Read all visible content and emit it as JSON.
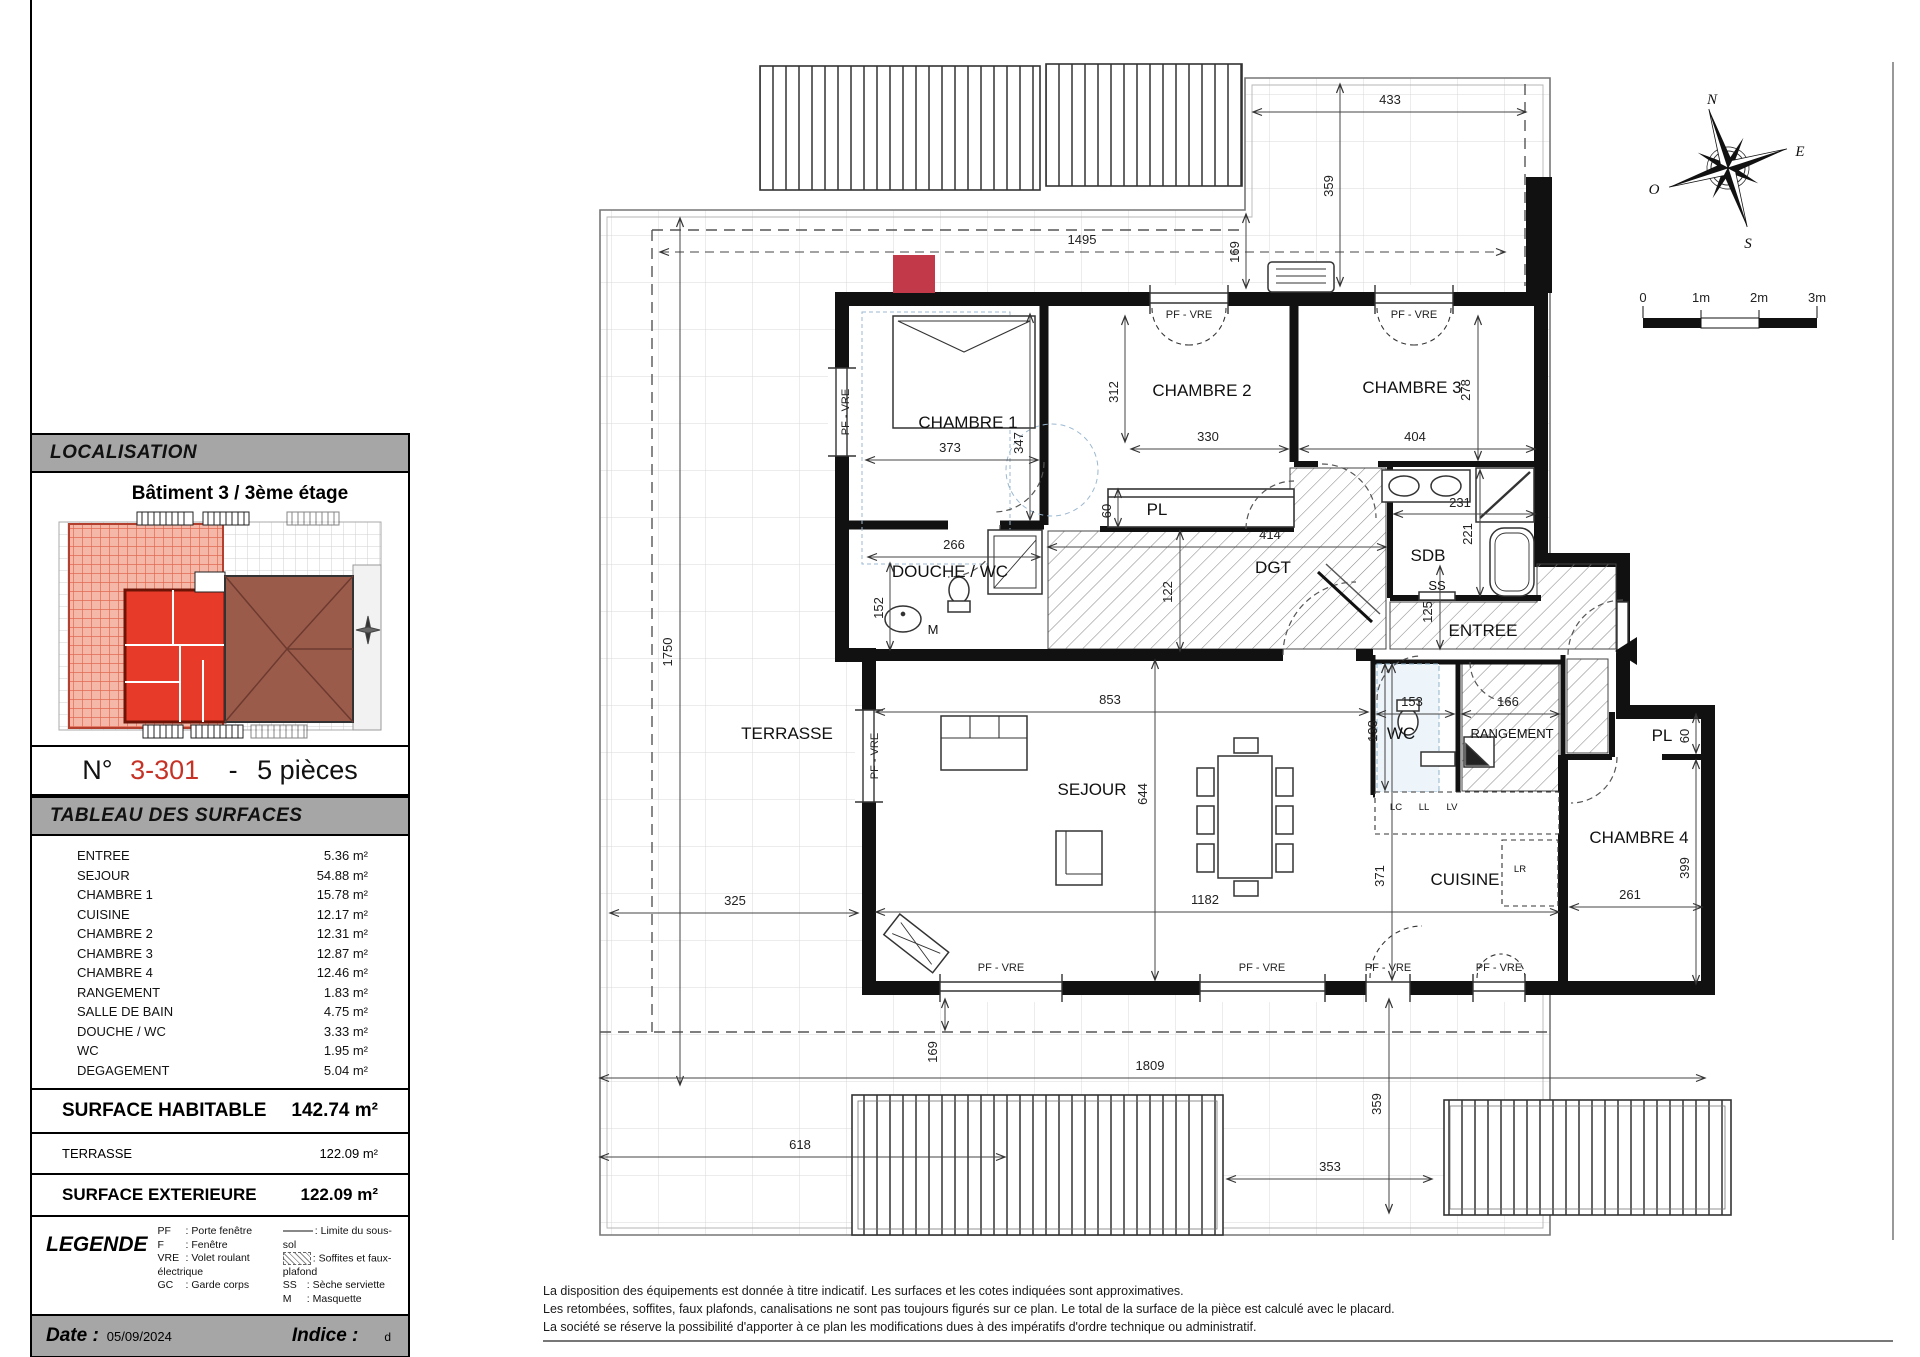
{
  "localisation": {
    "title": "LOCALISATION",
    "building": "Bâtiment 3 / 3ème étage"
  },
  "unit": {
    "prefix": "N°",
    "number": "3-301",
    "sep": "-",
    "type": "5 pièces"
  },
  "surfaces": {
    "title": "TABLEAU DES SURFACES",
    "rows": [
      {
        "name": "ENTREE",
        "area": "5.36 m²"
      },
      {
        "name": "SEJOUR",
        "area": "54.88 m²"
      },
      {
        "name": "CHAMBRE 1",
        "area": "15.78 m²"
      },
      {
        "name": "CUISINE",
        "area": "12.17 m²"
      },
      {
        "name": "CHAMBRE 2",
        "area": "12.31 m²"
      },
      {
        "name": "CHAMBRE 3",
        "area": "12.87 m²"
      },
      {
        "name": "CHAMBRE 4",
        "area": "12.46 m²"
      },
      {
        "name": "RANGEMENT",
        "area": "1.83 m²"
      },
      {
        "name": "SALLE DE BAIN",
        "area": "4.75 m²"
      },
      {
        "name": "DOUCHE / WC",
        "area": "3.33 m²"
      },
      {
        "name": "WC",
        "area": "1.95 m²"
      },
      {
        "name": "DEGAGEMENT",
        "area": "5.04 m²"
      }
    ],
    "habitable_label": "SURFACE HABITABLE",
    "habitable_value": "142.74 m²",
    "terrasse_label": "TERRASSE",
    "terrasse_value": "122.09 m²",
    "exterieure_label": "SURFACE EXTERIEURE",
    "exterieure_value": "122.09 m²"
  },
  "legende": {
    "title": "LEGENDE",
    "col1": [
      {
        "abbr": "PF",
        "label": ": Porte fenêtre"
      },
      {
        "abbr": "F",
        "label": ": Fenêtre"
      },
      {
        "abbr": "VRE",
        "label": ": Volet roulant électrique"
      },
      {
        "abbr": "GC",
        "label": ": Garde corps"
      }
    ],
    "col2": [
      {
        "abbr": "",
        "label": ": Limite du sous-sol"
      },
      {
        "abbr": "",
        "label": ": Soffites et faux-plafond"
      },
      {
        "abbr": "SS",
        "label": ": Sèche serviette"
      },
      {
        "abbr": "M",
        "label": ": Masquette"
      }
    ]
  },
  "footer": {
    "date_label": "Date :",
    "date": "05/09/2024",
    "indice_label": "Indice :",
    "indice": "d"
  },
  "disclaimer": {
    "line1": "La disposition des équipements est donnée à titre indicatif. Les surfaces et les cotes indiquées sont approximatives.",
    "line2": "Les retombées, soffites, faux plafonds, canalisations ne sont pas toujours figurés sur ce plan. Le total de la surface de la pièce est calculé avec le placard.",
    "line3": "La société se réserve la possibilité d'apporter à ce plan les modifications dues à des impératifs d'ordre technique ou administratif."
  },
  "plan": {
    "rooms": {
      "terrasse": "TERRASSE",
      "sejour": "SEJOUR",
      "cuisine": "CUISINE",
      "chambre1": "CHAMBRE 1",
      "chambre2": "CHAMBRE 2",
      "chambre3": "CHAMBRE 3",
      "chambre4": "CHAMBRE 4",
      "douche_wc": "DOUCHE / WC",
      "wc": "WC",
      "sdb": "SDB",
      "dgt": "DGT",
      "entree": "ENTREE",
      "rangement": "RANGEMENT",
      "pl": "PL",
      "ss": "SS",
      "m": "M"
    },
    "window_label": "PF - VRE",
    "appliances": {
      "lc": "LC",
      "ll": "LL",
      "lv": "LV",
      "lr": "LR"
    },
    "dims": {
      "d1495": "1495",
      "d433": "433",
      "d359_top": "359",
      "d169_top": "169",
      "d1750": "1750",
      "d373": "373",
      "d347": "347",
      "d312": "312",
      "d330": "330",
      "d404": "404",
      "d278": "278",
      "d266": "266",
      "d152": "152",
      "d122": "122",
      "d414": "414",
      "d60_pl": "60",
      "d231": "231",
      "d221": "221",
      "d125": "125",
      "d853": "853",
      "d644": "644",
      "d153": "153",
      "d138": "138",
      "d166": "166",
      "d60_pl4": "60",
      "d399": "399",
      "d325": "325",
      "d1182": "1182",
      "d261": "261",
      "d371": "371",
      "d169_bottom": "169",
      "d1809": "1809",
      "d359_bottom": "359",
      "d618": "618",
      "d353": "353"
    },
    "compass": {
      "n": "N",
      "e": "E",
      "s": "S",
      "o": "O"
    },
    "scale": {
      "t0": "0",
      "t1": "1m",
      "t2": "2m",
      "t3": "3m"
    }
  }
}
